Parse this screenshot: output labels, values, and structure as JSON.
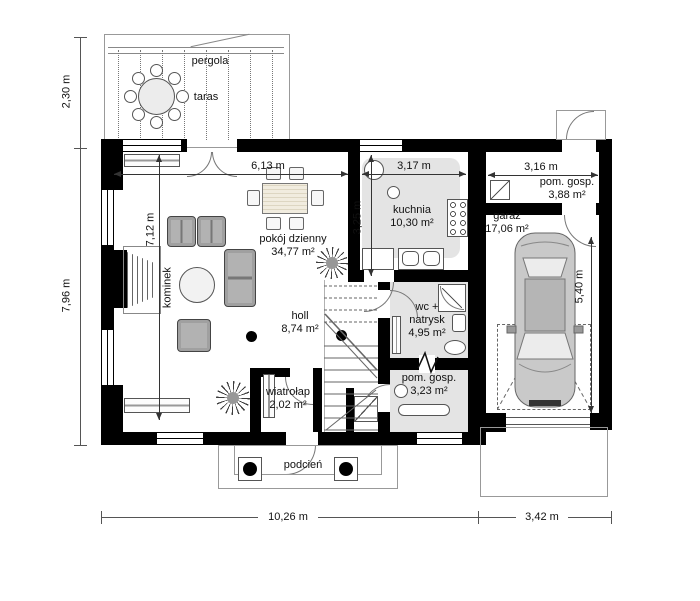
{
  "plan": {
    "labels": {
      "pergola": "pergola",
      "taras": "taras",
      "kominek": "kominek",
      "podcien": "podcień"
    },
    "rooms": {
      "living": {
        "name": "pokój dzienny",
        "area": "34,77 m²"
      },
      "kitchen": {
        "name": "kuchnia",
        "area": "10,30 m²"
      },
      "hall": {
        "name": "holl",
        "area": "8,74 m²"
      },
      "wc": {
        "line1": "wc +",
        "line2": "natrysk",
        "area": "4,95 m²"
      },
      "utility_lower": {
        "name": "pom. gosp.",
        "area": "3,23 m²"
      },
      "utility_upper": {
        "name": "pom. gosp.",
        "area": "3,88 m²"
      },
      "garage": {
        "name": "garaż",
        "area": "17,06 m²"
      },
      "vestibule": {
        "name": "wiatrołap",
        "area": "2,02 m²"
      }
    },
    "dims": {
      "terrace_depth": "2,30 m",
      "house_depth": "7,96 m",
      "house_width": "10,26 m",
      "garage_width": "3,42 m",
      "living_width": "6,13 m",
      "living_depth": "7,12 m",
      "kitchen_width": "3,17 m",
      "kitchen_depth": "3,25 m",
      "utility_width": "3,16 m",
      "garage_depth": "5,40 m"
    },
    "colors": {
      "wall": "#000000",
      "tiled_floor": "#e4e4e4",
      "background": "#ffffff"
    }
  }
}
